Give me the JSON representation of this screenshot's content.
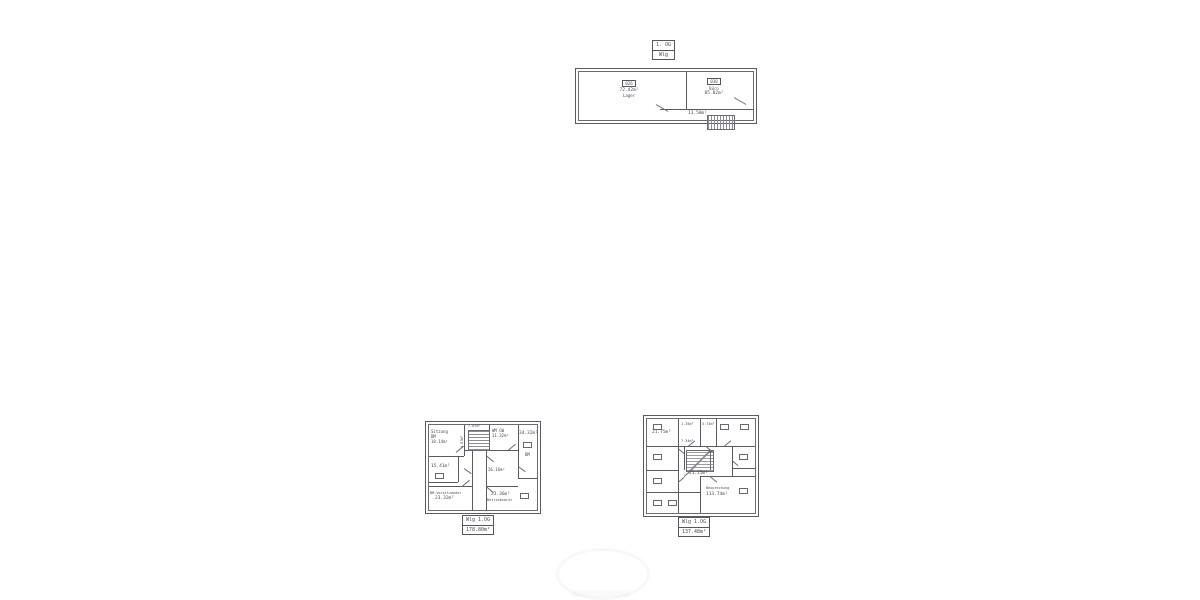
{
  "sheet": {
    "title_box": {
      "line1": "1. OG",
      "line2": "Wlg"
    }
  },
  "top_plan": {
    "left_room": {
      "code": "026",
      "area": "72.42m²",
      "name": "Lager"
    },
    "right_room": {
      "code": "030",
      "name": "Büro",
      "area": "85.02m²"
    },
    "corridor_area": "13.58m²"
  },
  "left_plan": {
    "room_sitzung_line1": "Sitzung",
    "room_sitzung_line2": "BM",
    "room_sitzung_area": "18.14m²",
    "stair_area": "7.07m²",
    "stair_side_area": "4.67m²",
    "room_wm_name": "WM GW",
    "room_wm_area": "11.32m²",
    "room_right_area": "34.32m²",
    "room_right_tag": "BM",
    "room_leftmid_area": "15.41m²",
    "room_center_area": "26.16m²",
    "room_bl_name": "BM-Vorsitzender",
    "room_bl_area": "23.32m²",
    "room_br_area": "23.36m²",
    "room_br_name": "Betriebsarzt",
    "caption_line1": "Wlg 1.OG",
    "caption_line2": "178.80m²"
  },
  "right_plan": {
    "room_topleft_area": "21.75m²",
    "small_area_a": "1.35m²",
    "small_area_b": "3.74m²",
    "small_area_c": "7.34m²",
    "corridor_area": "21.25m²",
    "room_br_name": "Besprechung",
    "room_br_area": "113.74m²",
    "caption_line1": "Wlg 1.OG",
    "caption_line2": "137.48m²"
  }
}
